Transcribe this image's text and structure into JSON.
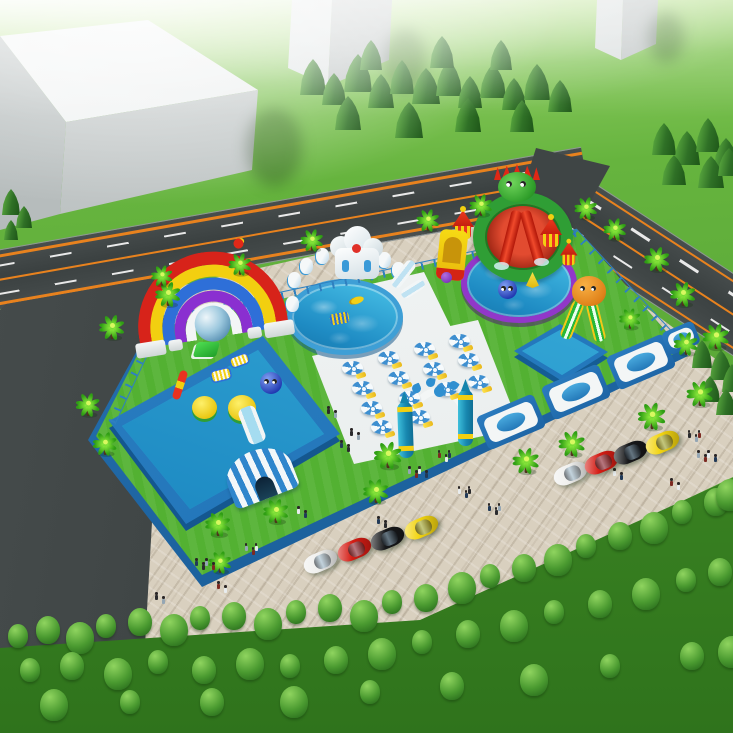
{
  "meta": {
    "label": "aerial 3d render of an inflatable water park with pools, slides, palm trees, parking and roads",
    "canvas": {
      "width": 733,
      "height": 733
    }
  },
  "palette": {
    "grass": "#5aa837",
    "grass_dark": "#3a8322",
    "pavement": "#d9d0bf",
    "asphalt": "#3f4545",
    "road_edge_line": "#e8821e",
    "road_dash": "#e9e9e9",
    "park_lawn": "#53b132",
    "park_wall_blue": "#2d7fc0",
    "pool_water": "#2aa2d8",
    "pool_rim_blue": "#1d6db2",
    "round_pool_ring_purple": "#9137c9",
    "deck_white": "#f3f6f6",
    "umbrella_blue": "#3e8fd0",
    "rainbow_colors": [
      "#d7231a",
      "#f2cf10",
      "#2e6fd8",
      "#8a2fd0",
      "#f3f5f6"
    ],
    "slide_red": "#e02815",
    "wheel_green": "#2f9e35",
    "castle_yellow": "#f2cf10",
    "octopus_orange": "#e0821a",
    "gate_teal": "#1888b0",
    "palm_green": "#49c820",
    "conifer_green": "#2f7026",
    "building_gray": "#c2c7c7",
    "car_colors": [
      "#f0f0ee",
      "#d41c14",
      "#17181a",
      "#f2d410"
    ]
  },
  "scene": {
    "buildings": 3,
    "roads": [
      "horizontal-road",
      "left-vertical-road",
      "right-diagonal-road"
    ],
    "pools": [
      {
        "name": "rectangular-pool-with-rainbow-arch",
        "feature": "rainbow entrance arch, duck and ball floats, striped tent slide"
      },
      {
        "name": "round-pool-ice-castle",
        "feature": "white inflatable castle and slides"
      },
      {
        "name": "round-pool-dragon-slide",
        "feature": "green wheel, red twin slides, castle towers, purple ring"
      },
      {
        "name": "square-kiddie-pool",
        "feature": "orange octopus slide"
      }
    ],
    "umbrella_count": 14,
    "palm_count": 25,
    "wall_module_count": 4,
    "entrance": {
      "pillars": 2,
      "decor": "dolphin arch sign"
    },
    "cars": [
      {
        "color": "white",
        "hex": "#f0f0ee"
      },
      {
        "color": "red",
        "hex": "#d41c14"
      },
      {
        "color": "black",
        "hex": "#17181a"
      },
      {
        "color": "yellow",
        "hex": "#f2d410"
      },
      {
        "color": "white",
        "hex": "#f0f0ee"
      },
      {
        "color": "red",
        "hex": "#d41c14"
      },
      {
        "color": "black",
        "hex": "#17181a"
      },
      {
        "color": "yellow",
        "hex": "#f2d410"
      }
    ],
    "people_estimate": 45
  }
}
